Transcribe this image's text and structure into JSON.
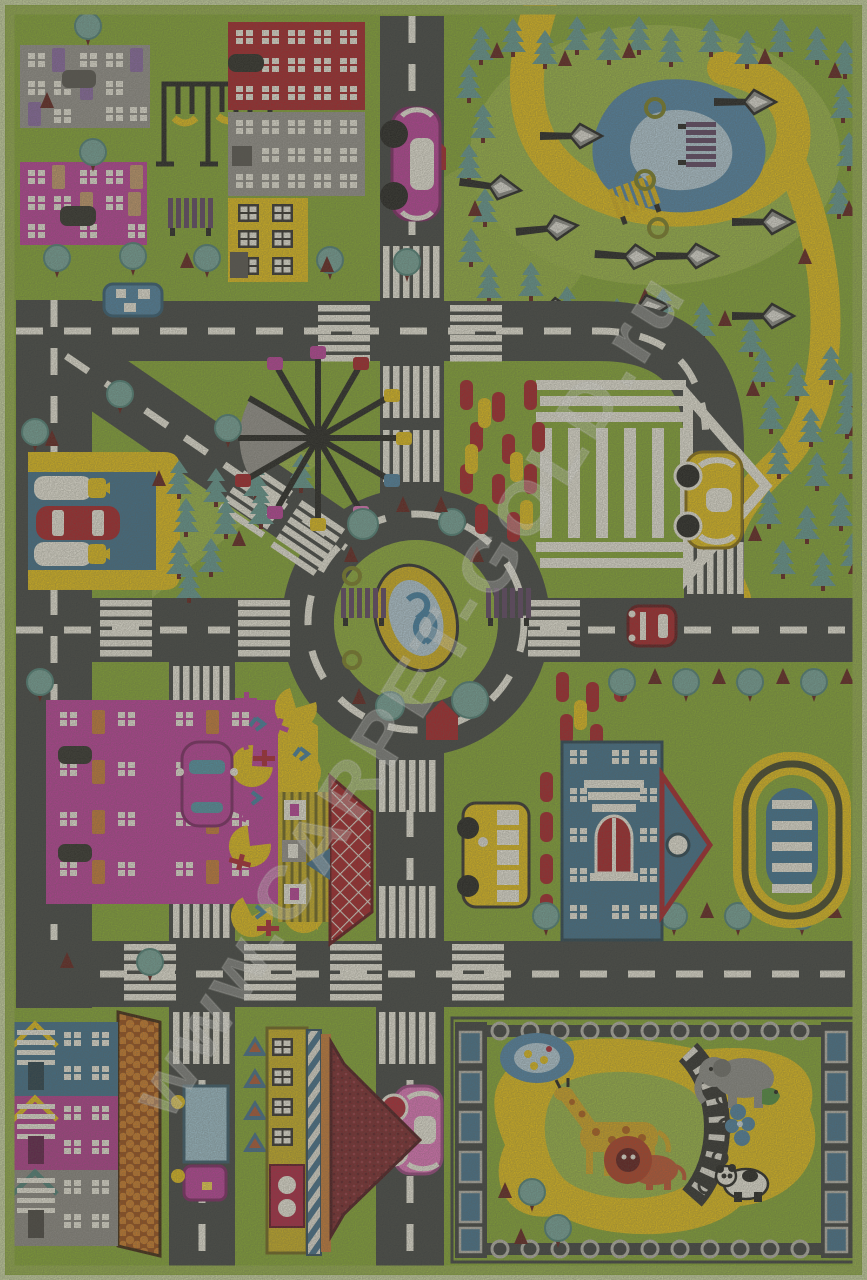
{
  "image": {
    "type": "photograph",
    "subject": "children's play rug with a toy city road-map design, seen from above"
  },
  "watermark": {
    "text": "www.CARPET-GOLD.ru"
  },
  "colors": {
    "grass": "#85a92f",
    "grassLight": "#9cba42",
    "island": "#8fb035",
    "road": "#3d403f",
    "dash": "#f2efe3",
    "white": "#f2efe3",
    "yellow": "#e9c214",
    "magenta": "#bf3a9c",
    "pinkLight": "#e873c0",
    "red": "#a81b22",
    "crimson": "#b01f3e",
    "maroon": "#5f1a16",
    "fir": "#619a92",
    "tree": "#74a59b",
    "treeEdge": "#4c8279",
    "pond": "#4e84aa",
    "pondLight": "#b7d0df",
    "gray": "#97948f",
    "grayDark": "#55524d",
    "purple": "#5c4063",
    "purpleWin": "#8a67a6",
    "tan": "#c89a6a",
    "blue": "#3c6e8c",
    "blueCar": "#4a81a4",
    "blueLight": "#9fc3d2",
    "stadiumBlue": "#3a7295",
    "orange": "#cb7a33",
    "olive": "#7b7f1f",
    "shingleBg": "#9c4a10",
    "shingleDot": "#d07a22",
    "roofMaroon": "#7a2026",
    "black": "#1d1d1b",
    "giraffe": "#d8a91c",
    "giraffeSpot": "#b35c12",
    "elephant": "#8e8e8a",
    "lion": "#b3391e",
    "lionBody": "#c2512b",
    "lionFace": "#5e1313",
    "borderLight": "#cfdca6",
    "borderMid": "#95b147"
  },
  "scene": {
    "regions": [
      "top-left: gray and magenta apartment blocks, swing set, trees, bench",
      "top-center: red, gray and yellow buildings; vertical road with pink car",
      "top-right: park with fir forest, yellow walking path, blue pond, street lamps, benches",
      "middle-left: gas station with fuel pumps and red car; fir grove",
      "center: ferris wheel, roundabout with fountain and benches, white gazebo, flower beds",
      "center-right: curved road with yellow car, fir forest with yellow trail",
      "lower-left: magenta apartment house with yellow roof, flower garden, pink cars",
      "lower-center: striped house with red diamond roof, yellow bus, crosswalks",
      "lower-right: blue school building, oval swimming stadium with lanes",
      "bottom-left: row houses with shingled roof, delivery truck",
      "bottom-center: tram depot building, pink car, fir triangles",
      "bottom-right: fenced zoo with duck pond, giraffe, elephant, lion, panda, track bridge"
    ]
  }
}
